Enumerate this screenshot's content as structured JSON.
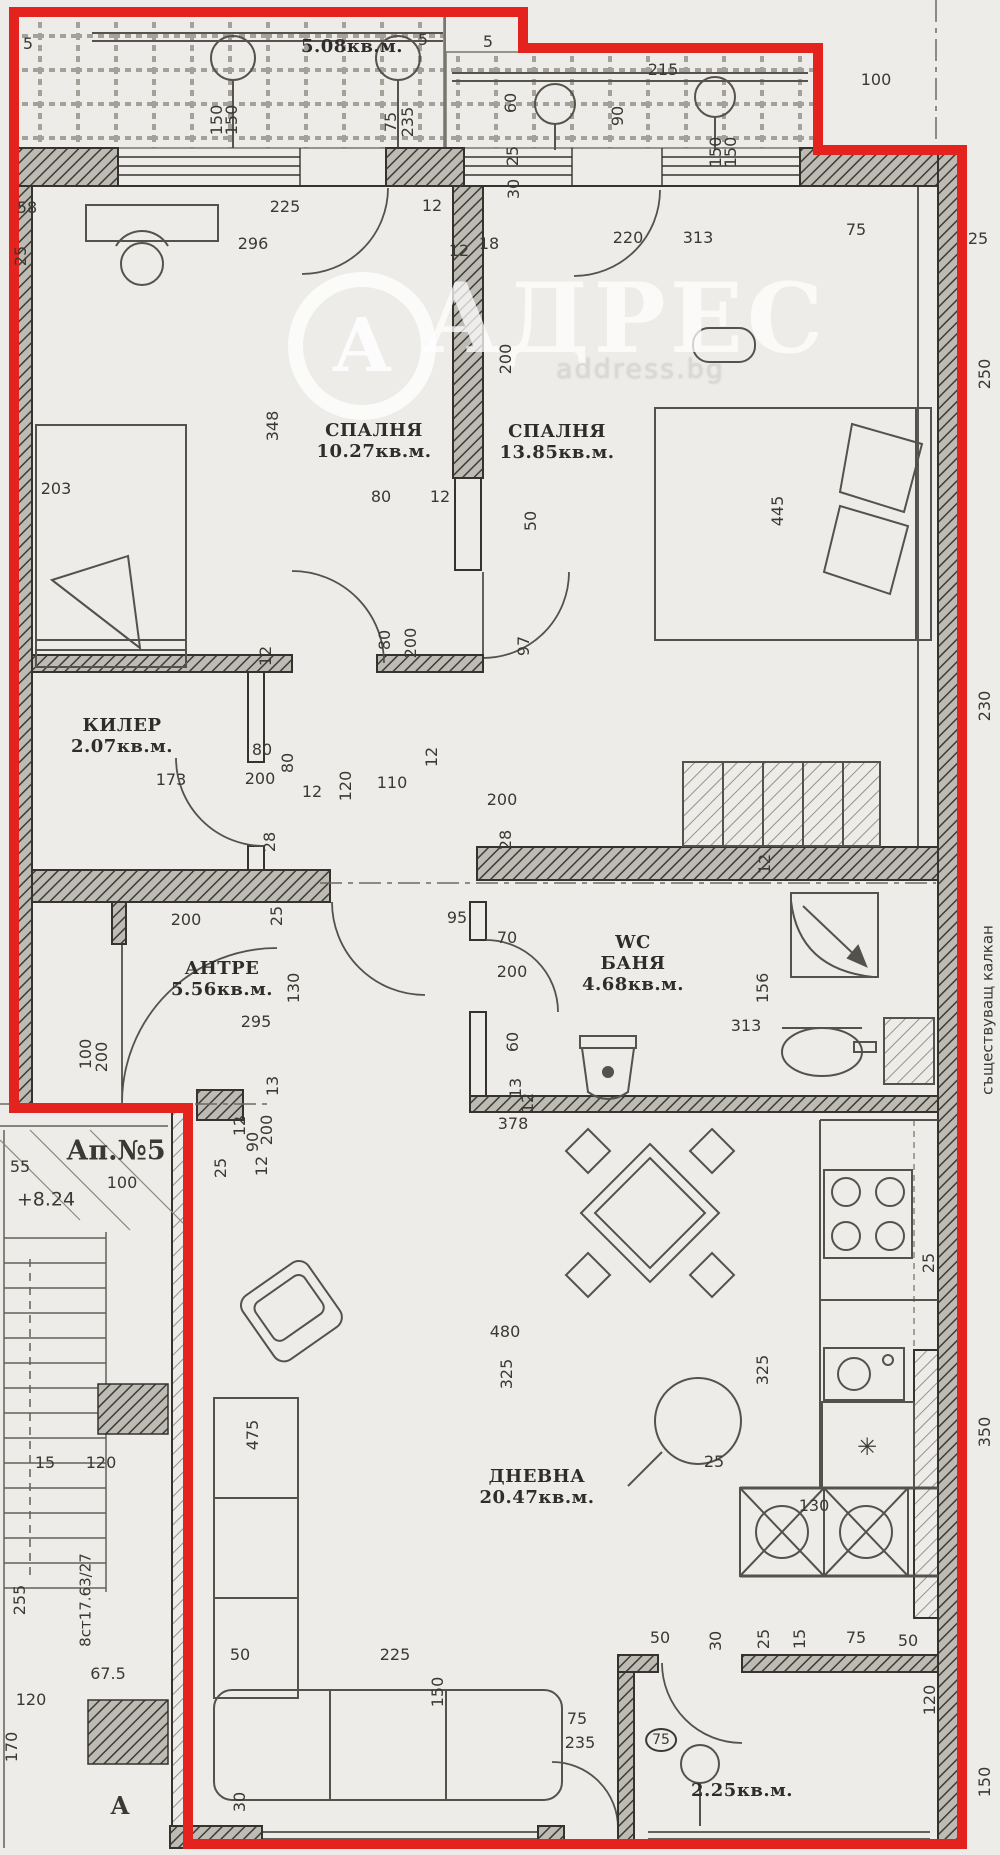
{
  "page": {
    "width": 1000,
    "height": 1855,
    "bg": "#edece8"
  },
  "colors": {
    "outline_red": "#e5231e",
    "ink": "#3a3934",
    "wall": "#34332e",
    "paper": "#edece8",
    "watermark": "rgba(255,255,255,0.78)"
  },
  "watermark": {
    "brand": "АДРЕС",
    "domain": "address.bg",
    "monogram": "А"
  },
  "rooms": [
    {
      "name": "terrace",
      "lines": [
        "5.08кв.м."
      ],
      "x": 352,
      "y": 36
    },
    {
      "name": "bedroom-1",
      "lines": [
        "СПАЛНЯ",
        "10.27кв.м."
      ],
      "x": 374,
      "y": 420
    },
    {
      "name": "bedroom-2",
      "lines": [
        "СПАЛНЯ",
        "13.85кв.м."
      ],
      "x": 557,
      "y": 421
    },
    {
      "name": "closet",
      "lines": [
        "КИЛЕР",
        "2.07кв.м."
      ],
      "x": 122,
      "y": 715
    },
    {
      "name": "hallway",
      "lines": [
        "АНТРЕ",
        "5.56кв.м."
      ],
      "x": 222,
      "y": 958
    },
    {
      "name": "bathroom",
      "lines": [
        "WC",
        "БАНЯ",
        "4.68кв.м."
      ],
      "x": 633,
      "y": 932
    },
    {
      "name": "living-room",
      "lines": [
        "ДНЕВНА",
        "20.47кв.м."
      ],
      "x": 537,
      "y": 1466
    },
    {
      "name": "balcony",
      "lines": [
        "2.25кв.м."
      ],
      "x": 742,
      "y": 1780
    }
  ],
  "labels": [
    {
      "t": "5",
      "x": 28,
      "y": 44
    },
    {
      "t": "5",
      "x": 423,
      "y": 40
    },
    {
      "t": "5",
      "x": 488,
      "y": 42
    },
    {
      "t": "150",
      "x": 217,
      "y": 120,
      "v": 1
    },
    {
      "t": "150",
      "x": 232,
      "y": 120,
      "v": 1
    },
    {
      "t": "75",
      "x": 391,
      "y": 122,
      "v": 1
    },
    {
      "t": "235",
      "x": 408,
      "y": 122,
      "v": 1
    },
    {
      "t": "215",
      "x": 663,
      "y": 70
    },
    {
      "t": "60",
      "x": 511,
      "y": 103,
      "v": 1
    },
    {
      "t": "90",
      "x": 618,
      "y": 116,
      "v": 1
    },
    {
      "t": "150",
      "x": 716,
      "y": 152,
      "v": 1
    },
    {
      "t": "150",
      "x": 731,
      "y": 152,
      "v": 1
    },
    {
      "t": "100",
      "x": 876,
      "y": 80
    },
    {
      "t": "25",
      "x": 513,
      "y": 156,
      "v": 1
    },
    {
      "t": "30",
      "x": 514,
      "y": 189,
      "v": 1
    },
    {
      "t": "58",
      "x": 27,
      "y": 208
    },
    {
      "t": "225",
      "x": 285,
      "y": 207
    },
    {
      "t": "12",
      "x": 432,
      "y": 206
    },
    {
      "t": "296",
      "x": 253,
      "y": 244
    },
    {
      "t": "25",
      "x": 21,
      "y": 256,
      "v": 1
    },
    {
      "t": "12",
      "x": 459,
      "y": 251
    },
    {
      "t": "18",
      "x": 489,
      "y": 244
    },
    {
      "t": "220",
      "x": 628,
      "y": 238
    },
    {
      "t": "313",
      "x": 698,
      "y": 238
    },
    {
      "t": "75",
      "x": 856,
      "y": 230
    },
    {
      "t": "25",
      "x": 978,
      "y": 239
    },
    {
      "t": "250",
      "x": 985,
      "y": 374,
      "v": 1
    },
    {
      "t": "203",
      "x": 56,
      "y": 489
    },
    {
      "t": "348",
      "x": 273,
      "y": 426,
      "v": 1
    },
    {
      "t": "80",
      "x": 381,
      "y": 497
    },
    {
      "t": "12",
      "x": 440,
      "y": 497
    },
    {
      "t": "200",
      "x": 506,
      "y": 359,
      "v": 1
    },
    {
      "t": "50",
      "x": 531,
      "y": 521,
      "v": 1
    },
    {
      "t": "445",
      "x": 778,
      "y": 511,
      "v": 1
    },
    {
      "t": "97",
      "x": 524,
      "y": 646,
      "v": 1
    },
    {
      "t": "12",
      "x": 266,
      "y": 656,
      "v": 1
    },
    {
      "t": "80",
      "x": 385,
      "y": 640,
      "v": 1
    },
    {
      "t": "200",
      "x": 411,
      "y": 643,
      "v": 1
    },
    {
      "t": "230",
      "x": 985,
      "y": 706,
      "v": 1
    },
    {
      "t": "80",
      "x": 262,
      "y": 750
    },
    {
      "t": "200",
      "x": 260,
      "y": 779
    },
    {
      "t": "80",
      "x": 288,
      "y": 763,
      "v": 1
    },
    {
      "t": "12",
      "x": 312,
      "y": 792
    },
    {
      "t": "120",
      "x": 346,
      "y": 786,
      "v": 1
    },
    {
      "t": "110",
      "x": 392,
      "y": 783
    },
    {
      "t": "28",
      "x": 270,
      "y": 842,
      "v": 1
    },
    {
      "t": "173",
      "x": 171,
      "y": 780
    },
    {
      "t": "200",
      "x": 502,
      "y": 800
    },
    {
      "t": "28",
      "x": 506,
      "y": 840,
      "v": 1
    },
    {
      "t": "12",
      "x": 432,
      "y": 757,
      "v": 1
    },
    {
      "t": "12",
      "x": 765,
      "y": 864,
      "v": 1
    },
    {
      "t": "200",
      "x": 186,
      "y": 920
    },
    {
      "t": "25",
      "x": 277,
      "y": 916,
      "v": 1
    },
    {
      "t": "95",
      "x": 457,
      "y": 918
    },
    {
      "t": "130",
      "x": 294,
      "y": 988,
      "v": 1
    },
    {
      "t": "295",
      "x": 256,
      "y": 1022
    },
    {
      "t": "70",
      "x": 507,
      "y": 938
    },
    {
      "t": "200",
      "x": 512,
      "y": 972
    },
    {
      "t": "313",
      "x": 746,
      "y": 1026
    },
    {
      "t": "156",
      "x": 763,
      "y": 988,
      "v": 1
    },
    {
      "t": "60",
      "x": 513,
      "y": 1042,
      "v": 1
    },
    {
      "t": "13",
      "x": 516,
      "y": 1088,
      "v": 1
    },
    {
      "t": "100",
      "x": 86,
      "y": 1054,
      "v": 1
    },
    {
      "t": "200",
      "x": 102,
      "y": 1057,
      "v": 1
    },
    {
      "t": "55",
      "x": 20,
      "y": 1167
    },
    {
      "t": "100",
      "x": 122,
      "y": 1183
    },
    {
      "t": "Ап.№5",
      "x": 116,
      "y": 1151,
      "s": 27,
      "b": 1,
      "serif": 1,
      "name": "apartment-number"
    },
    {
      "t": "+8.24",
      "x": 46,
      "y": 1200,
      "s": 19,
      "name": "elevation-mark"
    },
    {
      "t": "25",
      "x": 221,
      "y": 1168,
      "v": 1
    },
    {
      "t": "12",
      "x": 262,
      "y": 1166,
      "v": 1
    },
    {
      "t": "13",
      "x": 273,
      "y": 1086,
      "v": 1
    },
    {
      "t": "12",
      "x": 240,
      "y": 1126,
      "v": 1
    },
    {
      "t": "90",
      "x": 253,
      "y": 1142,
      "v": 1
    },
    {
      "t": "200",
      "x": 267,
      "y": 1130,
      "v": 1
    },
    {
      "t": "378",
      "x": 513,
      "y": 1124
    },
    {
      "t": "12",
      "x": 528,
      "y": 1103,
      "v": 1
    },
    {
      "t": "480",
      "x": 505,
      "y": 1332
    },
    {
      "t": "325",
      "x": 507,
      "y": 1374,
      "v": 1
    },
    {
      "t": "325",
      "x": 763,
      "y": 1370,
      "v": 1
    },
    {
      "t": "25",
      "x": 929,
      "y": 1263,
      "v": 1
    },
    {
      "t": "350",
      "x": 985,
      "y": 1432,
      "v": 1
    },
    {
      "t": "475",
      "x": 253,
      "y": 1435,
      "v": 1
    },
    {
      "t": "25",
      "x": 714,
      "y": 1462
    },
    {
      "t": "130",
      "x": 814,
      "y": 1506
    },
    {
      "t": "✳",
      "x": 867,
      "y": 1447,
      "s": 24,
      "name": "fridge-symbol"
    },
    {
      "t": "50",
      "x": 240,
      "y": 1655
    },
    {
      "t": "225",
      "x": 395,
      "y": 1655
    },
    {
      "t": "50",
      "x": 660,
      "y": 1638
    },
    {
      "t": "30",
      "x": 716,
      "y": 1641,
      "v": 1
    },
    {
      "t": "25",
      "x": 764,
      "y": 1639,
      "v": 1
    },
    {
      "t": "15",
      "x": 800,
      "y": 1639,
      "v": 1
    },
    {
      "t": "75",
      "x": 856,
      "y": 1638
    },
    {
      "t": "50",
      "x": 908,
      "y": 1641
    },
    {
      "t": "150",
      "x": 438,
      "y": 1692,
      "v": 1
    },
    {
      "t": "75",
      "x": 577,
      "y": 1719
    },
    {
      "t": "235",
      "x": 580,
      "y": 1743
    },
    {
      "t": "75",
      "x": 661,
      "y": 1740,
      "circ": 1,
      "s": 14
    },
    {
      "t": "30",
      "x": 240,
      "y": 1802,
      "v": 1
    },
    {
      "t": "15",
      "x": 45,
      "y": 1463
    },
    {
      "t": "120",
      "x": 101,
      "y": 1463
    },
    {
      "t": "8ст17.63/27",
      "x": 86,
      "y": 1600,
      "v": 1,
      "s": 15,
      "name": "stairs-note"
    },
    {
      "t": "255",
      "x": 20,
      "y": 1600,
      "v": 1
    },
    {
      "t": "67.5",
      "x": 108,
      "y": 1674
    },
    {
      "t": "120",
      "x": 31,
      "y": 1700
    },
    {
      "t": "170",
      "x": 12,
      "y": 1747,
      "v": 1
    },
    {
      "t": "А",
      "x": 120,
      "y": 1806,
      "s": 24,
      "b": 1,
      "serif": 1,
      "name": "section-mark"
    },
    {
      "t": "съществуващ калкан",
      "x": 988,
      "y": 1010,
      "v": 1,
      "s": 15,
      "name": "existing-wall-note"
    },
    {
      "t": "120",
      "x": 930,
      "y": 1700,
      "v": 1
    },
    {
      "t": "150",
      "x": 985,
      "y": 1782,
      "v": 1
    }
  ]
}
